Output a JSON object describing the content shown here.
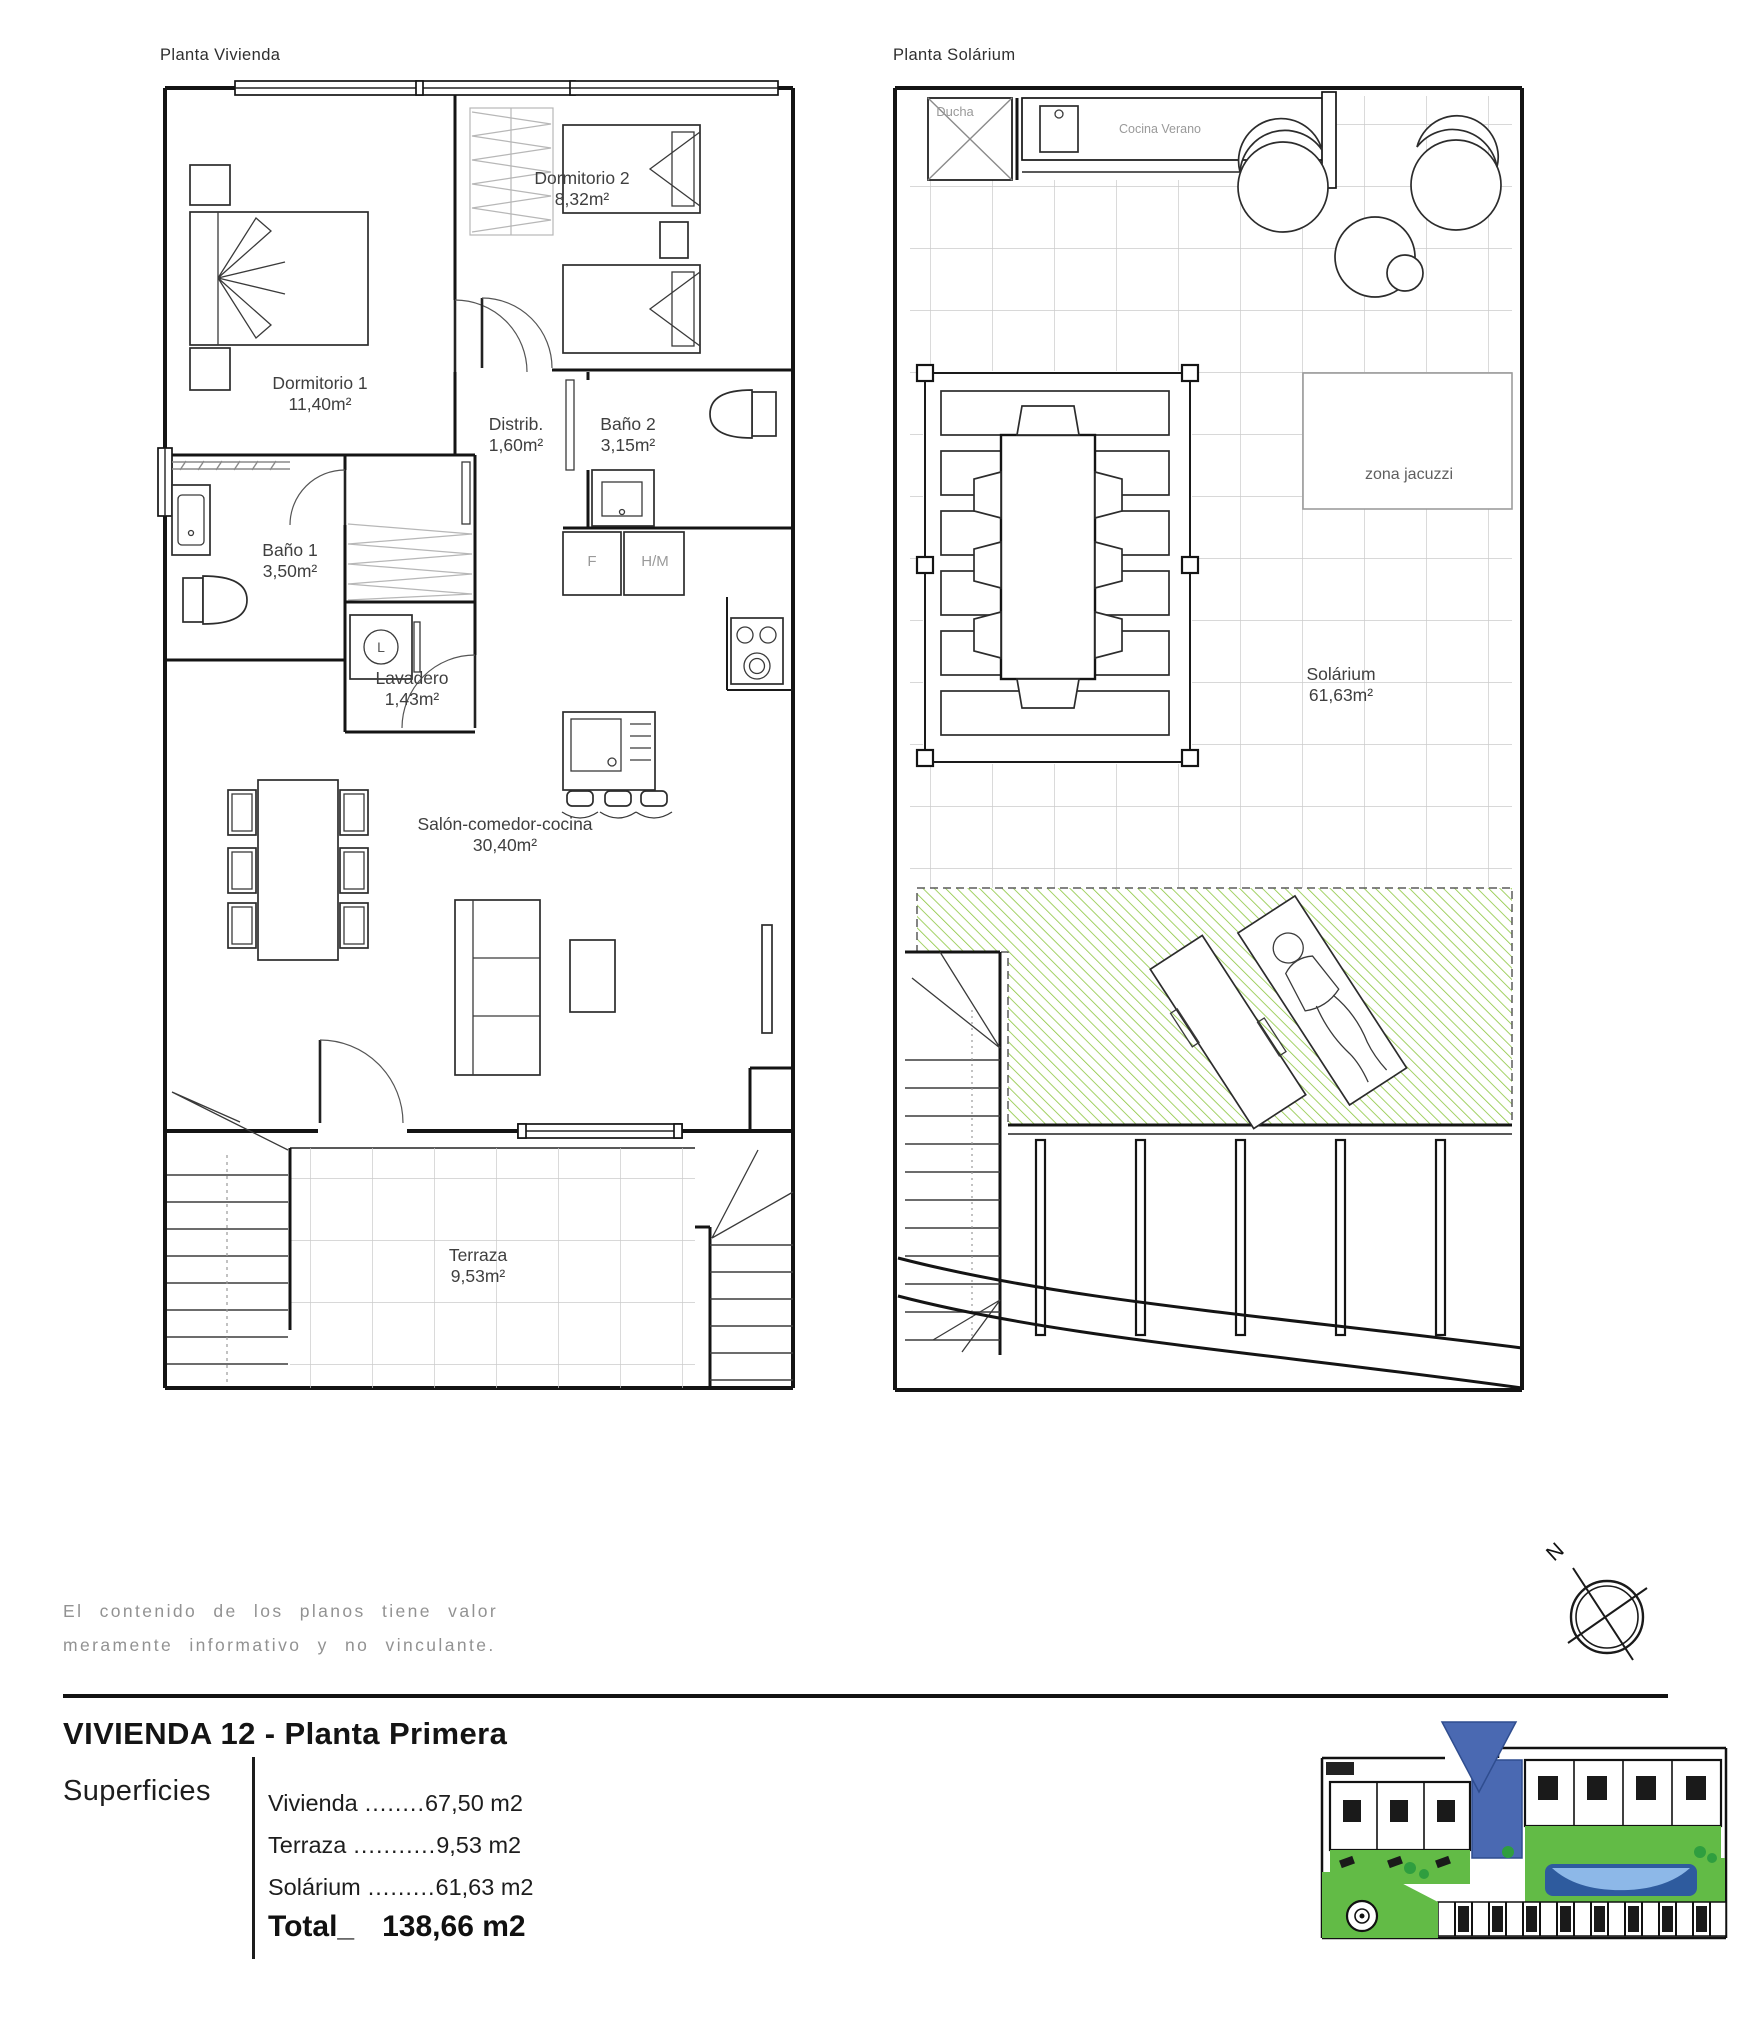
{
  "plans": {
    "vivienda": {
      "title": "Planta Vivienda",
      "rooms": [
        {
          "name": "Dormitorio 1",
          "area": "11,40m²"
        },
        {
          "name": "Dormitorio 2",
          "area": "8,32m²"
        },
        {
          "name": "Distrib.",
          "area": "1,60m²"
        },
        {
          "name": "Baño 2",
          "area": "3,15m²"
        },
        {
          "name": "Baño 1",
          "area": "3,50m²"
        },
        {
          "name": "Lavadero",
          "area": "1,43m²"
        },
        {
          "name": "Salón-comedor-cocina",
          "area": "30,40m²"
        },
        {
          "name": "Terraza",
          "area": "9,53m²"
        }
      ],
      "appliances": {
        "fridge": "F",
        "oven_micro": "H/M",
        "washer": "L"
      }
    },
    "solarium": {
      "title": "Planta Solárium",
      "labels": {
        "shower": "Ducha",
        "summer_kitchen": "Cocina Verano",
        "jacuzzi": "zona jacuzzi"
      },
      "room": {
        "name": "Solárium",
        "area": "61,63m²"
      }
    }
  },
  "disclaimer": {
    "line1": "El contenido de los planos tiene valor",
    "line2": "meramente informativo y no vinculante."
  },
  "summary": {
    "title": "VIVIENDA 12 - Planta Primera",
    "label": "Superficies",
    "rows": [
      {
        "name": "Vivienda",
        "dots": "........",
        "value": "67,50 m2"
      },
      {
        "name": "Terraza",
        "dots": "...........",
        "value": "9,53 m2"
      },
      {
        "name": "Solárium",
        "dots": ".........",
        "value": "61,63 m2"
      }
    ],
    "total": {
      "name": "Total_",
      "value": "138,66 m2"
    }
  },
  "compass": {
    "north": "N"
  },
  "colors": {
    "green_hatch": "#8cc63f",
    "site_green": "#62bb46",
    "site_blue": "#4a69b2",
    "pool_blue": "#2e5b9e",
    "pool_light": "#8db8e8"
  }
}
